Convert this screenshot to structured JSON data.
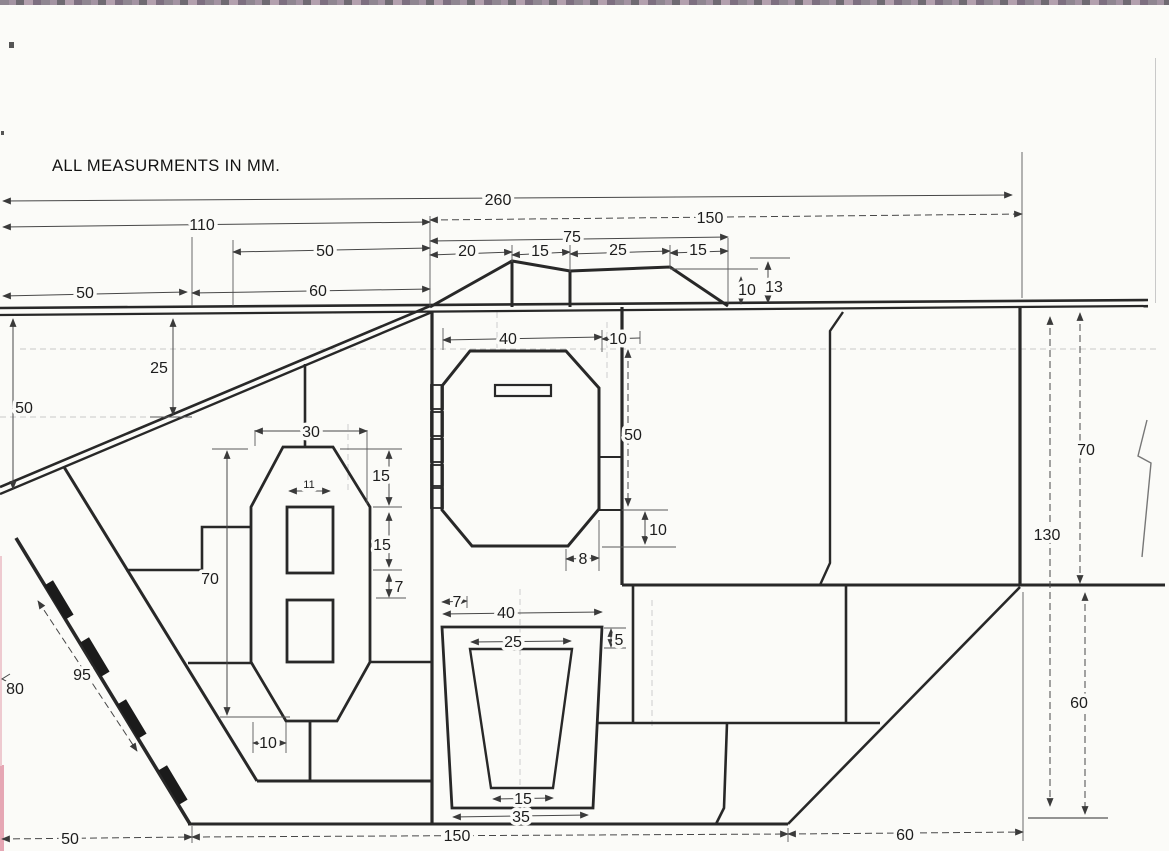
{
  "title": "ALL MEASURMENTS IN MM.",
  "drawing_type": "hand-drawn engineering side elevation with dimension lines",
  "units": "mm",
  "colors": {
    "ink": "#282828",
    "dim_line": "#474747",
    "paper": "#fbfbf8"
  },
  "dims": {
    "top": {
      "overall": "260",
      "upper_front": "110",
      "glacis_top": "50",
      "glacis_edge": "60",
      "front_overhang": "50",
      "roof_rear": "150",
      "cupola_total": "75",
      "cupola_rise": "20",
      "cupola_peak": "15",
      "cupola_flat": "25",
      "cupola_fall": "15",
      "cupola_step_h": "10",
      "cupola_h": "13"
    },
    "left": {
      "front_height": "50",
      "glacis_drop": "25",
      "plate_h": "70",
      "plate_w": "30",
      "slot_w": "11",
      "upper_seg": "15",
      "mid_seg": "15",
      "small_seg": "7",
      "foot_offset": "10",
      "lower_slope_len": "95",
      "glacis_len": "80"
    },
    "door": {
      "w": "40",
      "gap_r": "10",
      "h": "50",
      "gap_b": "10",
      "chamfer_b": "8"
    },
    "grille": {
      "corner": "7",
      "outer_w": "40",
      "inner_w_top": "25",
      "inset": "5",
      "inner_w_bot": "15",
      "outer_w_bot": "35"
    },
    "bottom": {
      "front": "50",
      "hull": "150",
      "rear": "60"
    },
    "right": {
      "upper_h": "70",
      "total_h": "130",
      "lower_h": "60"
    }
  }
}
